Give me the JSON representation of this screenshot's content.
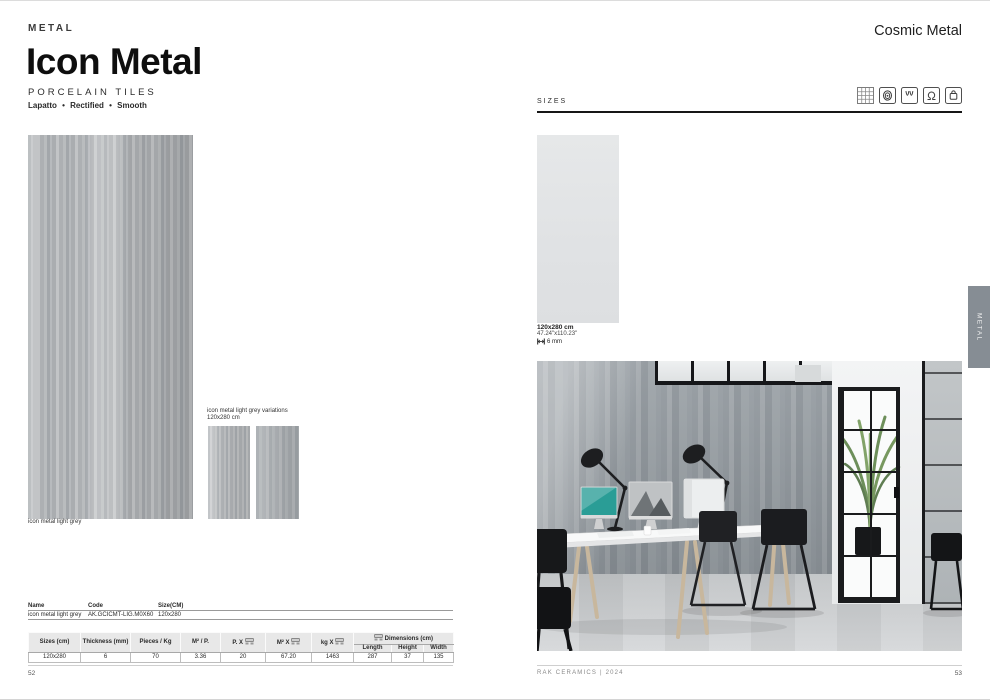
{
  "left_page": {
    "category": "METAL",
    "title": "Icon Metal",
    "subtitle": "PORCELAIN TILES",
    "finishes": "Lapatto • Rectified • Smooth",
    "main_tile_caption": "icon metal light grey",
    "variations_label_line1": "icon metal light grey variations",
    "variations_label_line2": "120x280 cm",
    "info_table": {
      "headers": [
        "Name",
        "Code",
        "Size(CM)"
      ],
      "row": [
        "icon metal light grey",
        "AK.GCICMT-LIG.M0X60",
        "120x280"
      ]
    },
    "spec_table": {
      "headers": [
        "Sizes (cm)",
        "Thickness (mm)",
        "Pieces / Kg",
        "M² / P.",
        "P. X",
        "M² X",
        "kg X"
      ],
      "dimensions_header": "Dimensions (cm)",
      "dimensions_sub": [
        "Length",
        "Height",
        "Width"
      ],
      "row": [
        "120x280",
        "6",
        "70",
        "3.36",
        "20",
        "67.20",
        "1463",
        "287",
        "37",
        "135"
      ]
    },
    "page_number": "52"
  },
  "right_page": {
    "collection": "Cosmic Metal",
    "sizes_label": "SIZES",
    "certification_icons": [
      "tile-grid",
      "fingerprint",
      "frost-waves",
      "omega",
      "bag"
    ],
    "size_swatch": {
      "size": "120x280 cm",
      "size_inches": "47.24\"x110.23\"",
      "thickness": "6 mm"
    },
    "footer": "RAK CERAMICS | 2024",
    "page_number": "53",
    "side_tab": "METAL"
  },
  "colors": {
    "tile_grey": "#aab0b4",
    "swatch_grey": "#e4e6e7",
    "tab_grey": "#868d94",
    "rule_dark": "#161616"
  }
}
